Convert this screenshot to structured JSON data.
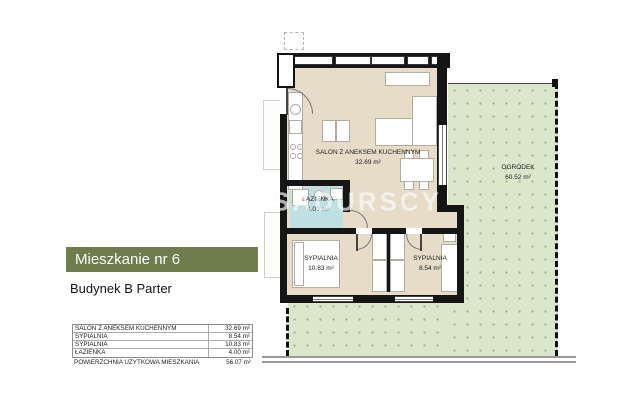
{
  "header": {
    "title": "Mieszkanie nr 6",
    "subtitle": "Budynek B Parter"
  },
  "area_table": {
    "rows": [
      {
        "label": "SALON Z ANEKSEM KUCHENNYM",
        "value": "32.69 m²"
      },
      {
        "label": "SYPIALNIA",
        "value": "8.54 m²"
      },
      {
        "label": "SYPIALNIA",
        "value": "10.83 m²"
      },
      {
        "label": "ŁAZIENKA",
        "value": "4.00 m²"
      }
    ],
    "total_label": "POWIERZCHNIA UŻYTKOWA MIESZKANIA",
    "total_value": "56.07 m²"
  },
  "floorplan": {
    "watermark": "SADURSCY",
    "rooms": {
      "salon": {
        "name": "SALON Z ANEKSEM KUCHENNYM",
        "area": "32.69 m²"
      },
      "bathroom": {
        "name": "ŁAZIENKA",
        "area": "4.00 m²"
      },
      "bedroom1": {
        "name": "SYPIALNIA",
        "area": "10.83 m²"
      },
      "bedroom2": {
        "name": "SYPIALNIA",
        "area": "8.54 m²"
      },
      "garden": {
        "name": "OGRÓDEK",
        "area": "60.52 m²"
      }
    },
    "colors": {
      "wall": "#151515",
      "floor": "#e6dcc7",
      "bathroom": "#bfe0e2",
      "garden": "#dbe7cb",
      "accent": "#6d7d4b"
    }
  }
}
